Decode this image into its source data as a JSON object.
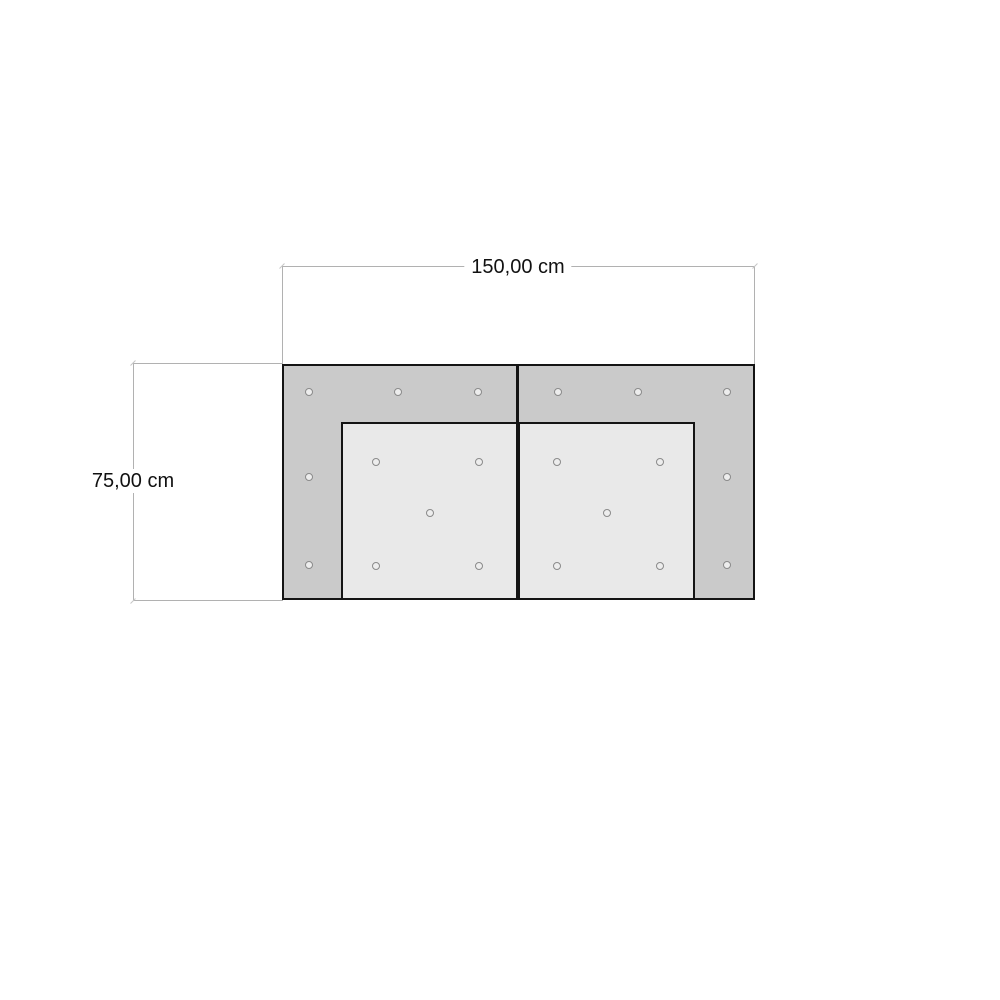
{
  "dimensions": {
    "width_label": "150,00 cm",
    "height_label": "75,00 cm"
  },
  "colors": {
    "background": "#ffffff",
    "frame_fill": "#cacaca",
    "seat_fill": "#e9e9e9",
    "outline": "#141414",
    "dim_line": "#b1b1b1",
    "dim_tick": "#c6c6c6",
    "dim_text": "#111111",
    "button_ring": "#8a8a8a",
    "button_fill": "#ededed"
  },
  "chart_data": {
    "type": "diagram",
    "title": "Sofa top-view technical drawing with overall dimensions",
    "overall_width_cm": 150.0,
    "overall_depth_cm": 75.0,
    "shape": {
      "frame_px": {
        "left": 282,
        "top": 364,
        "width": 473,
        "height": 236
      },
      "seats_px": [
        {
          "left": 341,
          "top": 422,
          "width": 177,
          "height": 178
        },
        {
          "left": 518,
          "top": 422,
          "width": 177,
          "height": 178
        }
      ]
    },
    "tufting_buttons_px": [
      {
        "x": 309,
        "y": 392
      },
      {
        "x": 398,
        "y": 392
      },
      {
        "x": 478,
        "y": 392
      },
      {
        "x": 558,
        "y": 392
      },
      {
        "x": 638,
        "y": 392
      },
      {
        "x": 727,
        "y": 392
      },
      {
        "x": 309,
        "y": 477
      },
      {
        "x": 727,
        "y": 477
      },
      {
        "x": 309,
        "y": 565
      },
      {
        "x": 727,
        "y": 565
      },
      {
        "x": 376,
        "y": 462
      },
      {
        "x": 479,
        "y": 462
      },
      {
        "x": 430,
        "y": 513
      },
      {
        "x": 376,
        "y": 566
      },
      {
        "x": 479,
        "y": 566
      },
      {
        "x": 557,
        "y": 462
      },
      {
        "x": 660,
        "y": 462
      },
      {
        "x": 607,
        "y": 513
      },
      {
        "x": 557,
        "y": 566
      },
      {
        "x": 660,
        "y": 566
      }
    ]
  }
}
